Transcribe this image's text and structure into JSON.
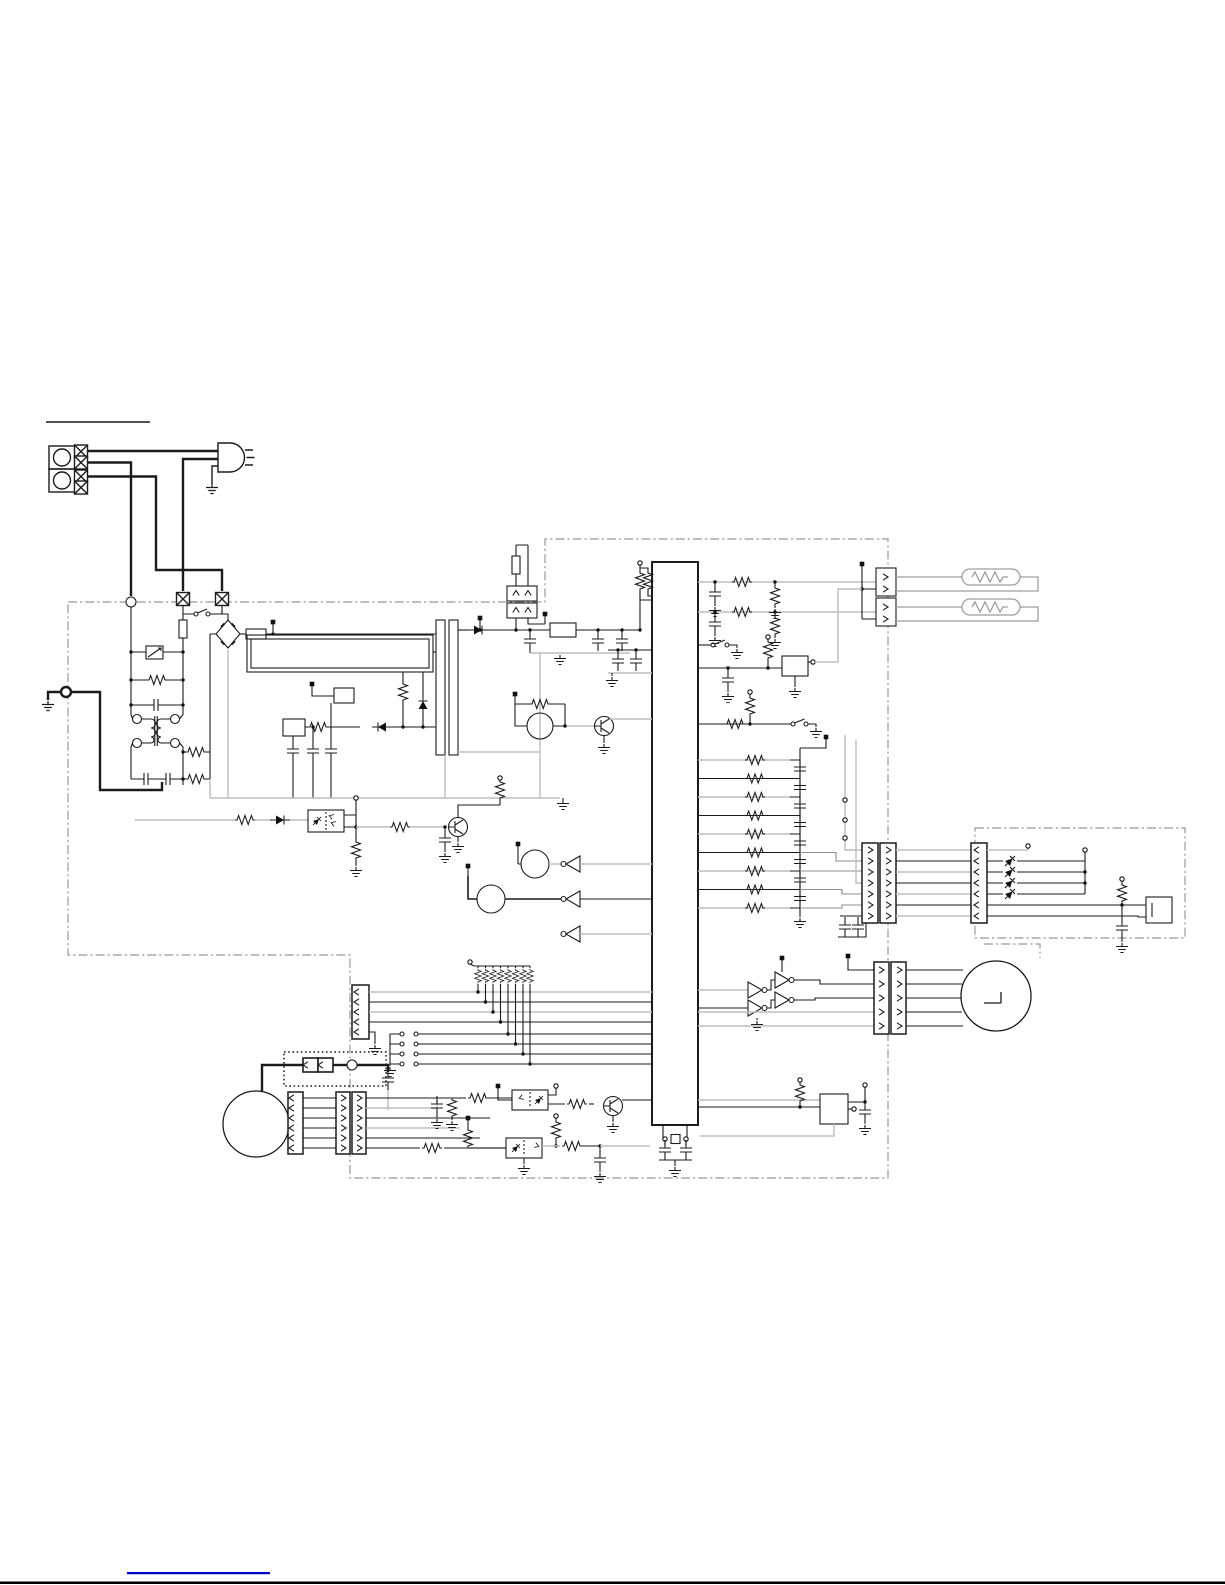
{
  "meta": {
    "description": "Service-manual style electrical circuit schematic of an appliance (no text labels printed). Mains plug and terminal block feed a control PCB (dash-dot outline) holding a mains filter, bridge rectifier, switch-mode power supply, a large vertical microcontroller IC with crystal, heater drive relays feeding two tubular heaters, a resistor ladder to a display PCB with 4 LEDs and a buzzer, thermistor sensing, a key/switch matrix, a DC motor with thermal cutout, opto-isolated triac drivers and a stepper-motor driver block.",
    "canvas": {
      "width": 1225,
      "height": 1585
    }
  },
  "colors": {
    "background": "#ffffff",
    "wire": "#1b1b1b",
    "wire_light": "#bdbdbd",
    "board_outline": "#999999",
    "component_fill": "#ffffff",
    "footer_rule": "#000000",
    "link_rule": "#0000cc"
  },
  "title": {
    "text": "",
    "underline_only": true
  },
  "schematic": {
    "boards": [
      {
        "name": "main-control-board",
        "outline_style": "dash-dot"
      },
      {
        "name": "display-board",
        "outline_style": "dash-dot"
      },
      {
        "name": "thermal-cutout-module",
        "outline_style": "dotted"
      }
    ],
    "components": [
      "ac-terminal-block",
      "power-plug",
      "protective-earth",
      "board-entry-connectors",
      "power-switch",
      "line-fuse",
      "varistor",
      "line-filter-transformer",
      "x-capacitors",
      "bridge-rectifier",
      "power-relay-block",
      "smps-transformer",
      "smps-controller",
      "thermal-fuse-connector",
      "voltage-regulator",
      "main-ic",
      "crystal-oscillator",
      "heater-drive-rc",
      "heater-connectors",
      "heater-1",
      "heater-2",
      "relay-driver",
      "resistor-ladder",
      "ladder-connector-pair",
      "display-connector",
      "led-1",
      "led-2",
      "led-3",
      "led-4",
      "buzzer",
      "temp-sensor-main",
      "thermistor-1",
      "thermistor-2",
      "inverter-buffers",
      "opto-feedback",
      "key-connector",
      "pullup-resistor-bank",
      "key-switches",
      "dc-motor",
      "motor-connector",
      "thermal-cutout",
      "triac-driver-1",
      "triac-driver-2",
      "stepper-drivers",
      "stepper-connector",
      "stepper-motor",
      "reset-ic"
    ],
    "led_count": 4,
    "key_switch_count": 4,
    "pullup_resistor_count": 8,
    "ladder_resistor_count": 9
  },
  "footer": {
    "has_black_rule": true,
    "has_blue_link_rule": true
  }
}
